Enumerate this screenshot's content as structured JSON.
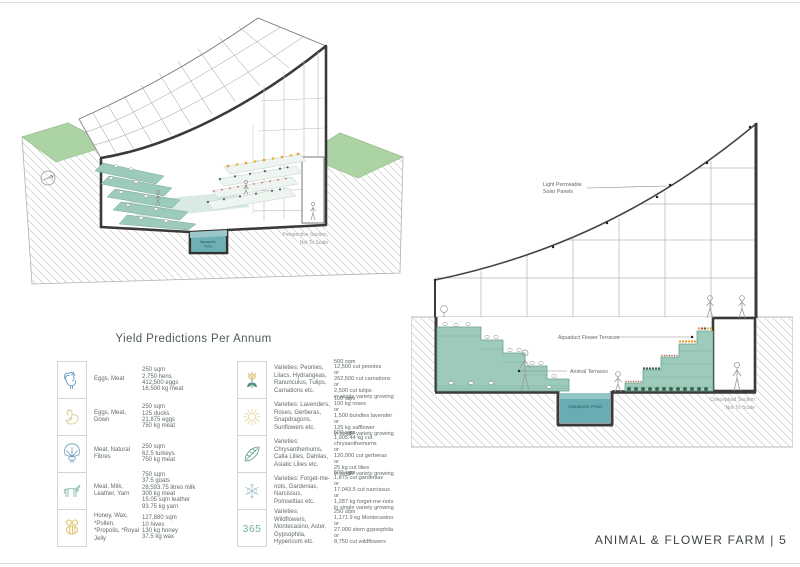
{
  "sheet": {
    "footer": "ANIMAL & FLOWER FARM | 5"
  },
  "perspective_drawing": {
    "caption_lines": [
      "Perspective Section,",
      "Not To Scale"
    ],
    "pond_label_lines": [
      "Aquaponic",
      "Pond"
    ]
  },
  "section_drawing": {
    "solar_label_lines": [
      "Light Permeable",
      "Solar Panels"
    ],
    "flower_terraces_label": "Aquaduct Flower Terraces",
    "animal_terraces_label": "Animal Terraces",
    "pond_label": "Aquaponic Pond",
    "caption_lines": [
      "Conceptual Section",
      "Not To Scale"
    ]
  },
  "yield_table": {
    "title": "Yield Predictions Per Annum",
    "animal_rows": [
      {
        "icon": "rooster-icon",
        "label": "Eggs, Meat",
        "values": [
          "250 sqm",
          "2,750 hens",
          "412,500 eggs",
          "16,500 kg meat"
        ]
      },
      {
        "icon": "duck-icon",
        "label": "Eggs, Meat, Down",
        "values": [
          "250 sqm",
          "125 ducks",
          "21,875 eggs",
          "750 kg meat"
        ]
      },
      {
        "icon": "turkey-icon",
        "label": "Meat, Natural Fibres",
        "values": [
          "250 sqm",
          "62.5 turkeys",
          "750 kg meat"
        ]
      },
      {
        "icon": "goat-icon",
        "label": "Meat, Milk, Leather, Yarn",
        "values": [
          "750 sqm",
          "37.5 goats",
          "28,593.75 litres milk",
          "300 kg meat",
          "15.05 sqm leather",
          "93.75 kg yarn"
        ]
      },
      {
        "icon": "bee-icon",
        "label": "Honey, Wax, *Pollen, *Propolis, *Royal Jelly",
        "values": [
          "127,880 sqm",
          "10 hives",
          "130 kg honey",
          "37.5 kg wax"
        ]
      }
    ],
    "flower_rows": [
      {
        "icon": "tulip-icon",
        "label": "Varieties: Peonies, Lilacs, Hydrangeas, Ranunculus, Tulips, Carnations etc.",
        "values": [
          "500 sqm",
          "12,500 cut peonies",
          "or",
          "262,500 cut carnations",
          "or",
          "2,500 cut tulips",
          "in single variety growing"
        ]
      },
      {
        "icon": "sun-icon",
        "label": "Varieties: Lavenders, Roses, Gerberas, Snapdragons, Sunflowers etc.",
        "values": [
          "100 sqm",
          "100 kg roses",
          "or",
          "1,500 bundles lavender",
          "or",
          "125 kg safflower",
          "in single variety growing"
        ]
      },
      {
        "icon": "leaf-icon",
        "label": "Varieties: Chrysanthemums, Calla Lilies, Dahlias, Asiatic Lilies etc.",
        "values": [
          "500 sqm",
          "1,905.44 kg cut chrysanthemums",
          "or",
          "120,000 cut gerberas",
          "or",
          "25 kg cut lilies",
          "in single variety growing"
        ]
      },
      {
        "icon": "snowflake-icon",
        "label": "Varieties: Forget-me-nots, Gardenias, Narcissus, Poinsettias etc.",
        "values": [
          "500 sqm",
          "1,875 cut gardenias",
          "or",
          "17,043.5 cut narcissus",
          "or",
          "1,287 kg forget-me-nots",
          "in single variety growing"
        ]
      },
      {
        "icon": "365-icon",
        "icon_text": "365",
        "label": "Varieties: Wildflowers, Montecasino, Aster, Gypsophila, Hypericum etc.",
        "values": [
          "250 sqm",
          "1,171.9 kg Montecasino",
          "or",
          "27,000 stem gypsophila",
          "or",
          "8,750 cut wildflowers"
        ]
      }
    ]
  },
  "colors": {
    "terrace_teal": "#9ccabb",
    "pond_teal": "#69acb2",
    "grass_green": "#abd3a3",
    "flower_orange": "#e8a33d",
    "flower_red": "#c65043",
    "foliage_green": "#41694f",
    "outline_dark": "#3a3a3a"
  }
}
